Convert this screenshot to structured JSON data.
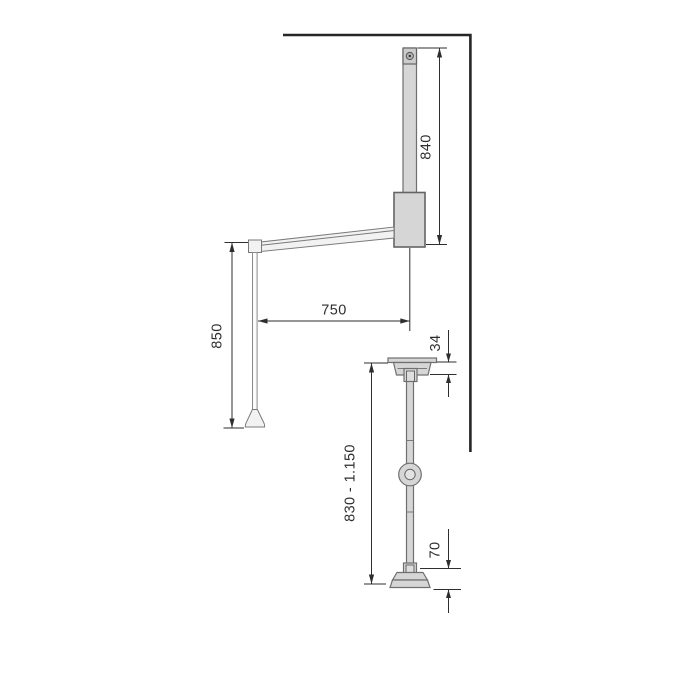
{
  "colors": {
    "background": "#ffffff",
    "part_fill": "#d6d6d6",
    "part_fill_light": "#f2f2f2",
    "part_outline": "#6f6f6f",
    "dimension_color": "#2e2e2e",
    "wall_line_color": "#262626"
  },
  "front_view": {
    "tube_height_label": "840",
    "arm_reach_label": "750",
    "drop_height_label": "850"
  },
  "side_view": {
    "bracket_height_label": "34",
    "adjustable_height_label": "830 - 1.150",
    "base_height_label": "70"
  }
}
